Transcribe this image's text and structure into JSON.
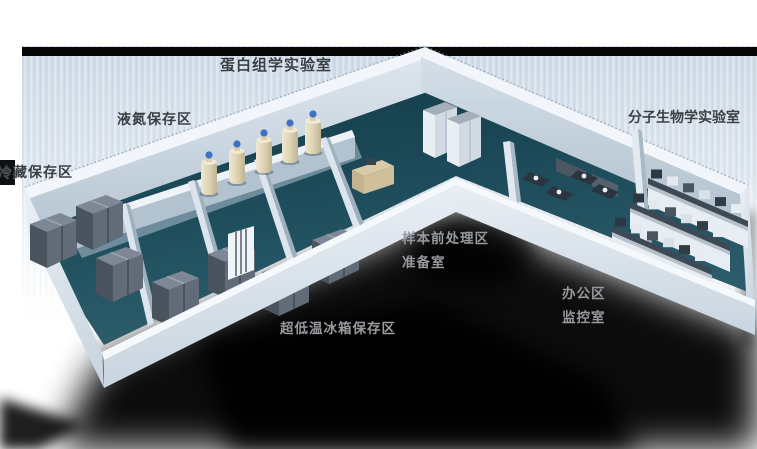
{
  "labels": {
    "proteomics_lab": "蛋白组学实验室",
    "liquid_nitrogen_area": "液氮保存区",
    "cold_storage_area": "冷藏保存区",
    "molecular_biology_lab": "分子生物学实验室",
    "sample_pretreatment_area": "样本前处理区",
    "preparation_room": "准备室",
    "office_area": "办公区",
    "monitoring_room": "监控室",
    "ulf_freezer_area": "超低温冰箱保存区"
  },
  "colors": {
    "floor_teal": "#1f4e5c",
    "wall_light": "#e9eff5",
    "background_blue": "#d5dfe9",
    "top_bar_black": "#060606",
    "label_dark": "#3a3f44",
    "label_light": "#979a9e",
    "tank_body": "#ddd3b4",
    "tank_cap_blue": "#3b72c4",
    "freezer_gray": "#5f6a76",
    "shadow_black": "#000000"
  }
}
